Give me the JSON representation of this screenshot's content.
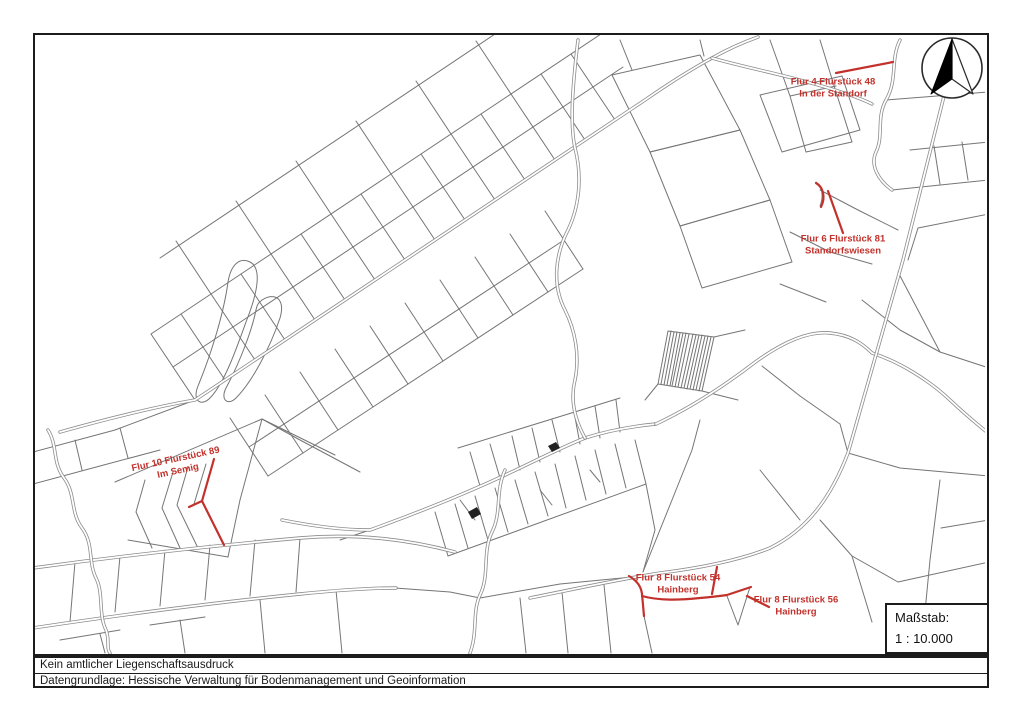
{
  "document": {
    "type_note": "Kein amtlicher Liegenschaftsausdruck",
    "source_note": "Datengrundlage: Hessische Verwaltung für Bodenmanagement und Geoinformation"
  },
  "scale_box": {
    "label": "Maßstab:",
    "value": "1 : 10.000"
  },
  "icons": [
    {
      "name": "north-arrow-icon",
      "meaning": "compass north arrow"
    }
  ],
  "colors": {
    "highlight": "#c2312b",
    "line": "#757575",
    "road": "#8c8c8c",
    "frame": "#1c1c1c"
  },
  "parcel_labels": [
    {
      "id": "flur-4-flurstueck-48",
      "line1": "Flur 4 Flurstück 48",
      "line2": "In der Standorf",
      "x": 833,
      "y": 89,
      "rotation": 0
    },
    {
      "id": "flur-6-flurstueck-81",
      "line1": "Flur 6 Flurstück 81",
      "line2": "Standorfswiesen",
      "x": 843,
      "y": 246,
      "rotation": 0
    },
    {
      "id": "flur-10-flurstueck-89",
      "line1": "Flur 10 Flurstück 89",
      "line2": "Im Semig",
      "x": 177,
      "y": 466,
      "rotation": -12
    },
    {
      "id": "flur-8-flurstueck-54",
      "line1": "Flur 8 Flurstück 54",
      "line2": "Hainberg",
      "x": 678,
      "y": 585,
      "rotation": 0
    },
    {
      "id": "flur-8-flurstueck-56",
      "line1": "Flur 8 Flurstück 56",
      "line2": "Hainberg",
      "x": 796,
      "y": 607,
      "rotation": 0
    }
  ],
  "map": {
    "line_color": "#757575",
    "road_color": "#8c8c8c",
    "highlight_color": "#c2312b",
    "base_paths": [
      "M195,400 L151,334",
      "M225,380 L181,314",
      "M255,360 L211,294",
      "M285,340 L241,274",
      "M315,320 L271,254",
      "M345,300 L301,234",
      "M375,280 L331,214",
      "M405,260 L361,194",
      "M435,240 L391,174",
      "M465,220 L421,154",
      "M495,200 L451,134",
      "M525,180 L481,114",
      "M555,160 L511,94",
      "M585,140 L541,74",
      "M615,120 L571,54",
      "M151,334 L601,34",
      "M173,367 L623,67",
      "M211,294 L176,241",
      "M271,254 L236,201",
      "M331,214 L296,161",
      "M391,174 L356,121",
      "M451,134 L416,81",
      "M511,94 L476,41",
      "M160,258 L510,24",
      "M230,418 L268,476",
      "M265,395 L303,453",
      "M300,372 L338,430",
      "M335,349 L373,407",
      "M370,326 L408,384",
      "M405,303 L443,361",
      "M440,280 L478,338",
      "M475,257 L513,315",
      "M510,234 L548,292",
      "M545,211 L583,269",
      "M268,476 L583,269",
      "M249,447 L564,240",
      "M250,262 C262,268 258,292 246,322 C236,350 224,384 210,398 C201,407 192,401 198,386 C212,352 224,312 228,282 C231,264 240,257 250,262 Z",
      "M262,300 C274,292 286,298 280,318 C270,348 252,382 236,398 C228,406 220,400 226,388 C240,362 252,330 256,310 C257,305 258,303 262,300 Z",
      "M33,452 L115,430 L195,400",
      "M33,484 L100,466 L160,450",
      "M75,440 L82,470",
      "M120,428 L128,458",
      "M115,482 L262,419",
      "M262,419 L335,455",
      "M128,540 L228,557",
      "M145,480 L136,512 L152,548",
      "M173,472 L162,508 L180,548",
      "M188,467 L177,505 L197,546",
      "M206,464 L194,504",
      "M262,419 L240,500 L228,557",
      "M360,472 L300,440 L262,419",
      "M435,512 L448,556",
      "M455,504 L468,548",
      "M475,496 L488,540",
      "M495,488 L508,532",
      "M515,480 L528,524",
      "M535,472 L548,516",
      "M555,464 L566,508",
      "M575,456 L586,500",
      "M595,450 L606,494",
      "M615,444 L626,488",
      "M635,440 L646,484",
      "M448,556 L646,484",
      "M480,486 L470,452",
      "M500,478 L490,444",
      "M520,470 L512,436",
      "M540,462 L532,428",
      "M560,452 L552,420",
      "M580,444 L574,412",
      "M600,438 L595,406",
      "M620,432 L616,400",
      "M458,448 L620,398",
      "M460,500 L475,520",
      "M540,490 L552,505",
      "M590,470 L600,482",
      "M646,484 L655,530 L643,572",
      "M658,384 L668,331 L714,337 L702,391 Z",
      "M661,384 L671,331",
      "M664,385 L674,332",
      "M667,385 L677,332",
      "M670,386 L680,333",
      "M672,386 L683,333",
      "M675,387 L686,333",
      "M678,387 L689,334",
      "M681,388 L693,334",
      "M684,388 L696,335",
      "M687,389 L699,335",
      "M690,389 L702,335",
      "M693,390 L705,336",
      "M696,390 L708,336",
      "M699,391 L711,337",
      "M645,400 L658,384",
      "M702,391 L738,400",
      "M714,337 L745,330",
      "M612,75 L700,55 L740,130 L650,152 Z",
      "M650,152 L740,130 L770,200 L680,226 Z",
      "M680,226 L770,200 L792,262 L702,288 Z",
      "M760,95 L842,76 L860,130 L782,152 Z",
      "M620,40 L632,70",
      "M700,40 L704,56",
      "M770,40 L790,96 L806,152",
      "M820,40 L836,92 L852,142",
      "M790,96 L836,86",
      "M806,152 L852,142",
      "M892,190 L989,180",
      "M910,150 L989,142",
      "M886,100 L989,92",
      "M918,228 L989,214",
      "M934,146 L940,184",
      "M962,142 L968,180",
      "M918,228 L908,260",
      "M898,272 L940,352",
      "M940,352 L989,368",
      "M862,300 L900,330 L940,352",
      "M790,232 L830,252 L872,264",
      "M820,190 L858,210 L898,230",
      "M780,284 L826,302",
      "M816,182 C822,186 824,196 820,206",
      "M762,366 L800,396 L840,424",
      "M840,424 L848,453",
      "M700,420 L692,450 L672,500 L643,572",
      "M760,470 L800,520",
      "M727,596 L738,625 L750,587",
      "M820,520 L852,556 L898,582",
      "M898,582 L989,562",
      "M852,556 L872,622",
      "M940,480 L930,560 L921,653",
      "M989,520 L941,528",
      "M848,453 L900,468 L989,476",
      "M480,598 L560,584 L642,576",
      "M520,598 L526,653",
      "M562,592 L568,653",
      "M604,585 L611,653",
      "M644,616 L652,653",
      "M75,562 L70,622",
      "M120,556 L115,612",
      "M165,550 L160,606",
      "M210,545 L205,600",
      "M255,540 L250,596",
      "M300,538 L296,592",
      "M100,634 L105,653",
      "M180,620 L185,653",
      "M260,600 L265,653",
      "M336,590 L342,653",
      "M60,640 L120,630",
      "M150,625 L205,617",
      "M395,588 L450,592 L480,598",
      "M340,540 L370,530"
    ],
    "road_paths": [
      "M60,432 C110,418 160,406 195,400 L645,100 C668,84 690,70 712,58 C728,49 744,42 758,37",
      "M282,520 C312,526 342,530 370,530 C420,512 470,492 520,468 C545,456 565,446 585,438 C610,430 635,426 656,424",
      "M656,424 C690,408 724,386 754,363 C784,341 810,331 830,333 C850,335 862,343 872,353 C900,362 930,381 950,400 C968,417 982,428 988,433",
      "M578,40 C572,90 570,125 575,148 C582,175 580,205 568,230 C555,255 552,285 565,310 C575,330 580,355 575,380 C570,400 575,420 585,438",
      "M958,40 L903,260 L848,453 C830,500 806,530 770,548 C740,560 700,568 660,573 C620,579 575,589 530,598",
      "M33,568 C120,556 210,546 300,538 C360,533 410,540 455,552",
      "M33,628 C120,615 220,602 300,594 C340,590 370,588 396,588",
      "M48,430 C58,446 52,462 64,478 C76,494 70,512 82,528 C94,544 88,562 96,578 C104,594 98,614 106,630 C110,640 106,648 110,653",
      "M505,470 C495,492 502,512 492,532 C482,552 490,575 480,595 C472,612 478,632 470,653",
      "M900,40 C890,60 898,80 886,100 C876,118 884,136 876,152 C870,165 878,180 892,190",
      "M712,58 C740,66 770,72 800,80 C830,88 856,96 872,104"
    ],
    "fill_paths": [
      "M548,446 L556,442 L560,448 L552,452 Z",
      "M468,512 L477,507 L481,514 L472,519 Z"
    ],
    "red_paths": [
      "M836,73 L893,62",
      "M828,191 L843,233",
      "M816,183 C823,187 826,197 821,207",
      "M214,459 L202,501 L224,545",
      "M202,501 L189,507",
      "M717,567 L712,594",
      "M747,596 L769,607",
      "M629,576 C637,581 641,586 642,594 L644,616",
      "M642,596 C660,601 680,600 700,598 C712,597 720,596 727,595 L751,587"
    ]
  }
}
